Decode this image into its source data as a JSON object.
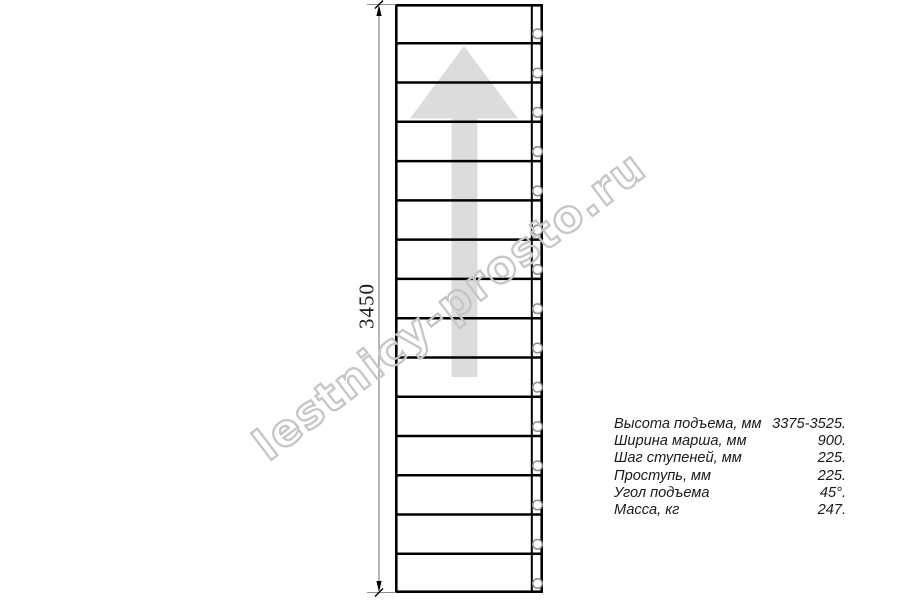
{
  "watermark": {
    "text": "lestnicy-prosto.ru",
    "color": "#c6c6c6"
  },
  "drawing": {
    "type": "staircase-plan-top-view",
    "steps_count": 15,
    "dimension_label": "3450",
    "colors": {
      "outline": "#000000",
      "arrow_fill": "#dcdcdc",
      "baluster_stroke": "#8c8c8c",
      "dimension_line": "#8f8f8f"
    }
  },
  "specs": {
    "rows": [
      {
        "label": "Высота подъема, мм",
        "value": "3375-3525."
      },
      {
        "label": "Ширина марша, мм",
        "value": "900."
      },
      {
        "label": "Шаг ступеней, мм",
        "value": "225."
      },
      {
        "label": "Проступь, мм",
        "value": "225."
      },
      {
        "label": "Угол подъема",
        "value": "45°."
      },
      {
        "label": "Масса, кг",
        "value": "247."
      }
    ]
  }
}
